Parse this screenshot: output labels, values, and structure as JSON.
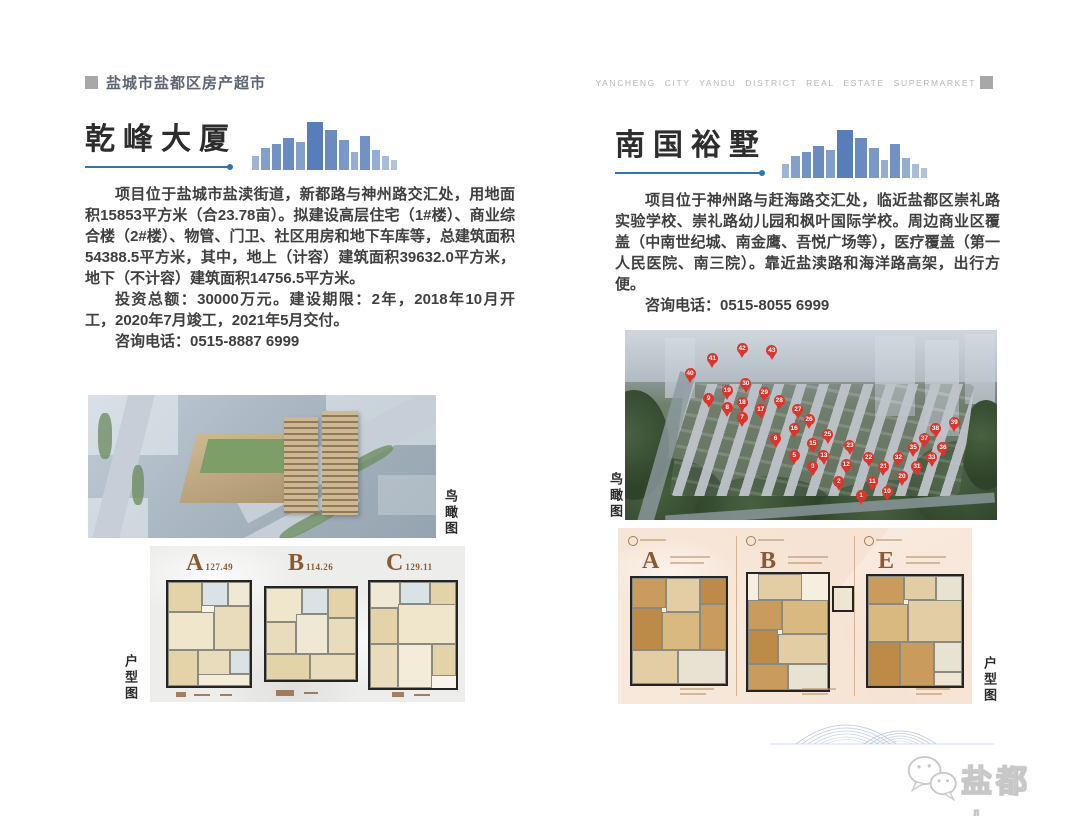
{
  "header": {
    "title_cn": "盐城市盐都区房产超市",
    "title_en": "YANCHENG CITY YANDU DISTRICT REAL ESTATE SUPERMARKET"
  },
  "left_project": {
    "title": "乾峰大厦",
    "paragraph1": "项目位于盐城市盐渎街道，新都路与神州路交汇处，用地面积15853平方米（合23.78亩）。拟建设高层住宅（1#楼）、商业综合楼（2#楼）、物管、门卫、社区用房和地下车库等，总建筑面积54388.5平方米，其中，地上（计容）建筑面积39632.0平方米，地下（不计容）建筑面积14756.5平方米。",
    "paragraph2": "投资总额：30000万元。建设期限：2年，2018年10月开工，2020年7月竣工，2021年5月交付。",
    "phone": "咨询电话：0515-8887 6999",
    "aerial_label": "鸟瞰图",
    "floorplan_label": "户型图",
    "floorplans": [
      {
        "letter": "A",
        "area": "127.49"
      },
      {
        "letter": "B",
        "area": "114.26"
      },
      {
        "letter": "C",
        "area": "129.11"
      }
    ]
  },
  "right_project": {
    "title": "南国裕墅",
    "paragraph1": "项目位于神州路与赶海路交汇处，临近盐都区崇礼路实验学校、崇礼路幼儿园和枫叶国际学校。周边商业区覆盖（中南世纪城、南金鹰、吾悦广场等），医疗覆盖（第一人民医院、南三院）。靠近盐渎路和海洋路高架，出行方便。",
    "phone": "咨询电话：0515-8055 6999",
    "aerial_label": "鸟瞰图",
    "floorplan_label": "户型图",
    "floorplans": [
      {
        "letter": "A"
      },
      {
        "letter": "B"
      },
      {
        "letter": "E"
      }
    ],
    "pins": [
      {
        "n": 1,
        "x": 62,
        "y": 84
      },
      {
        "n": 2,
        "x": 56,
        "y": 77
      },
      {
        "n": 3,
        "x": 49,
        "y": 69
      },
      {
        "n": 5,
        "x": 44,
        "y": 63
      },
      {
        "n": 6,
        "x": 39,
        "y": 54
      },
      {
        "n": 7,
        "x": 30,
        "y": 43
      },
      {
        "n": 8,
        "x": 26,
        "y": 38
      },
      {
        "n": 9,
        "x": 21,
        "y": 33
      },
      {
        "n": 10,
        "x": 69,
        "y": 82
      },
      {
        "n": 11,
        "x": 65,
        "y": 77
      },
      {
        "n": 12,
        "x": 58,
        "y": 68
      },
      {
        "n": 13,
        "x": 52,
        "y": 63
      },
      {
        "n": 15,
        "x": 49,
        "y": 57
      },
      {
        "n": 16,
        "x": 44,
        "y": 49
      },
      {
        "n": 17,
        "x": 35,
        "y": 39
      },
      {
        "n": 18,
        "x": 30,
        "y": 35
      },
      {
        "n": 19,
        "x": 26,
        "y": 29
      },
      {
        "n": 20,
        "x": 73,
        "y": 74
      },
      {
        "n": 21,
        "x": 68,
        "y": 69
      },
      {
        "n": 22,
        "x": 64,
        "y": 64
      },
      {
        "n": 23,
        "x": 59,
        "y": 58
      },
      {
        "n": 25,
        "x": 53,
        "y": 52
      },
      {
        "n": 26,
        "x": 48,
        "y": 44
      },
      {
        "n": 27,
        "x": 45,
        "y": 39
      },
      {
        "n": 28,
        "x": 40,
        "y": 34
      },
      {
        "n": 29,
        "x": 36,
        "y": 30
      },
      {
        "n": 30,
        "x": 31,
        "y": 25
      },
      {
        "n": 31,
        "x": 77,
        "y": 69
      },
      {
        "n": 32,
        "x": 72,
        "y": 64
      },
      {
        "n": 33,
        "x": 81,
        "y": 64
      },
      {
        "n": 35,
        "x": 76,
        "y": 59
      },
      {
        "n": 36,
        "x": 84,
        "y": 59
      },
      {
        "n": 37,
        "x": 79,
        "y": 54
      },
      {
        "n": 38,
        "x": 82,
        "y": 49
      },
      {
        "n": 39,
        "x": 87,
        "y": 46
      },
      {
        "n": 40,
        "x": 16,
        "y": 20
      },
      {
        "n": 41,
        "x": 22,
        "y": 12
      },
      {
        "n": 42,
        "x": 30,
        "y": 7
      },
      {
        "n": 43,
        "x": 38,
        "y": 8
      }
    ]
  },
  "footer": {
    "brand": "盐都人",
    "wechat_icon": "wechat-logo"
  },
  "colors": {
    "accent_blue": "#2e74b6",
    "skyline_blue": "#4f77b5",
    "pin_red": "#df342a",
    "panel_gray": "#ededec",
    "panel_pink": "#f6e3d3",
    "header_gray": "#5d6672",
    "header_en_gray": "#b5b5b5",
    "plan_label_brown": "#8a5a33"
  }
}
